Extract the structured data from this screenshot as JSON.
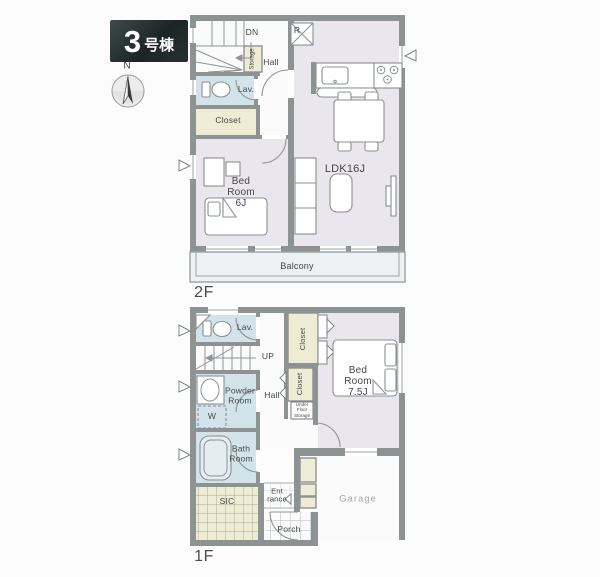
{
  "colors": {
    "wall": "#8d9293",
    "tatami": "#eae6ee",
    "wet": "#d2e3ea",
    "closet": "#efecd5",
    "balcony": "#edf1f3",
    "text": "#464646",
    "garagetext": "#a3a7a7",
    "paper": "#fcfcfd"
  },
  "header": {
    "unit_number": "3",
    "unit_type": "号棟",
    "compass_north": "N"
  },
  "floor2": {
    "floor_label": "2F",
    "labels": {
      "down": "DN",
      "storage": "Storage",
      "hall": "Hall",
      "lavatory": "Lav.",
      "closet": "Closet",
      "bedroom": "Bed\nRoom\n6J",
      "ldk": "LDK16J",
      "refrigerator": "R",
      "balcony": "Balcony"
    }
  },
  "floor1": {
    "floor_label": "1F",
    "labels": {
      "lavatory": "Lav.",
      "up": "UP",
      "closet_bedroom": "Closet",
      "closet_hall": "Closet",
      "under_floor_storage": "Under\nFloor\nStorage",
      "bedroom": "Bed\nRoom\n7.5J",
      "powder_room": "Powder\nRoom",
      "hall": "Hall",
      "washer": "W",
      "bath_room": "Bath\nRoom",
      "shoes_in_closet": "SIC",
      "entrance": "Ent\nrance",
      "porch": "Porch",
      "garage": "Garage"
    }
  }
}
